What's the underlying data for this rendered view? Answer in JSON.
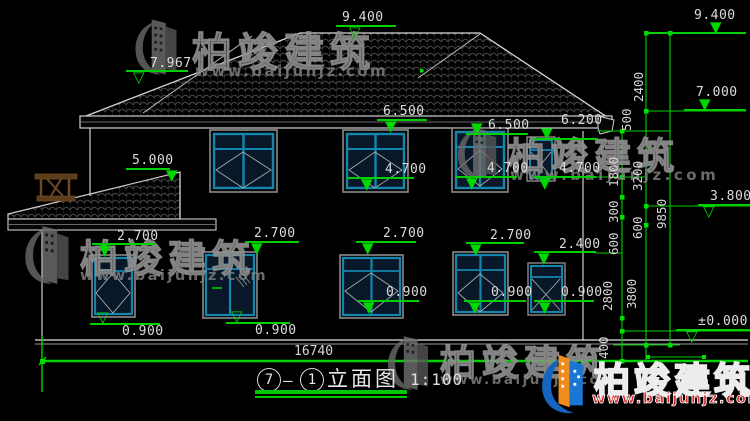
{
  "watermark": {
    "brand": "柏竣建筑",
    "url": "www.baijunjz.com",
    "logo_icon": "baijun-building-swoosh-logo"
  },
  "title": {
    "circle_left": "7",
    "dash": "—",
    "circle_right": "1",
    "name": "立面图",
    "scale": "1:100"
  },
  "bottom_dimension": "16740",
  "elevation_markers": [
    {
      "label": "7.967",
      "text_x": 150,
      "text_y": 57,
      "line_x": 126,
      "line_y": 70,
      "line_w": 62,
      "tri_x": 133,
      "tri_y": 70,
      "style": "hollow"
    },
    {
      "label": "9.400",
      "text_x": 342,
      "text_y": 11,
      "line_x": 336,
      "line_y": 25,
      "line_w": 60,
      "tri_x": 349,
      "tri_y": 25,
      "style": "hollow"
    },
    {
      "label": "9.400",
      "text_x": 694,
      "text_y": 9,
      "line_x": 646,
      "line_y": 32,
      "line_w": 100,
      "tri_x": 710,
      "tri_y": 20,
      "style": "solid"
    },
    {
      "label": "7.000",
      "text_x": 696,
      "text_y": 86,
      "line_x": 684,
      "line_y": 109,
      "line_w": 62,
      "tri_x": 699,
      "tri_y": 97,
      "style": "solid"
    },
    {
      "label": "6.500",
      "text_x": 383,
      "text_y": 105,
      "line_x": 377,
      "line_y": 119,
      "line_w": 50,
      "tri_x": 385,
      "tri_y": 119,
      "style": "solid"
    },
    {
      "label": "6.500",
      "text_x": 488,
      "text_y": 119,
      "line_x": 466,
      "line_y": 133,
      "line_w": 62,
      "tri_x": 471,
      "tri_y": 121,
      "style": "solid"
    },
    {
      "label": "6.200",
      "text_x": 561,
      "text_y": 114,
      "line_x": 534,
      "line_y": 138,
      "line_w": 64,
      "tri_x": 541,
      "tri_y": 126,
      "style": "solid"
    },
    {
      "label": "5.000",
      "text_x": 132,
      "text_y": 154,
      "line_x": 126,
      "line_y": 168,
      "line_w": 44,
      "tri_x": 166,
      "tri_y": 168,
      "style": "solid"
    },
    {
      "label": "4.700",
      "text_x": 385,
      "text_y": 163,
      "line_x": 348,
      "line_y": 177,
      "line_w": 66,
      "tri_x": 361,
      "tri_y": 177,
      "style": "solid"
    },
    {
      "label": "4.700",
      "text_x": 487,
      "text_y": 162,
      "line_x": 455,
      "line_y": 176,
      "line_w": 62,
      "tri_x": 466,
      "tri_y": 176,
      "style": "solid"
    },
    {
      "label": "4.700",
      "text_x": 559,
      "text_y": 162,
      "line_x": 534,
      "line_y": 176,
      "line_w": 62,
      "tri_x": 539,
      "tri_y": 176,
      "style": "solid"
    },
    {
      "label": "2.700",
      "text_x": 117,
      "text_y": 230,
      "line_x": 92,
      "line_y": 243,
      "line_w": 64,
      "tri_x": 99,
      "tri_y": 243,
      "style": "solid"
    },
    {
      "label": "2.700",
      "text_x": 254,
      "text_y": 227,
      "line_x": 245,
      "line_y": 241,
      "line_w": 54,
      "tri_x": 251,
      "tri_y": 241,
      "style": "solid"
    },
    {
      "label": "2.700",
      "text_x": 383,
      "text_y": 227,
      "line_x": 356,
      "line_y": 241,
      "line_w": 60,
      "tri_x": 362,
      "tri_y": 241,
      "style": "solid"
    },
    {
      "label": "2.700",
      "text_x": 490,
      "text_y": 229,
      "line_x": 466,
      "line_y": 242,
      "line_w": 58,
      "tri_x": 470,
      "tri_y": 242,
      "style": "solid"
    },
    {
      "label": "2.400",
      "text_x": 559,
      "text_y": 238,
      "line_x": 534,
      "line_y": 251,
      "line_w": 62,
      "tri_x": 538,
      "tri_y": 251,
      "style": "solid"
    },
    {
      "label": "0.900",
      "text_x": 122,
      "text_y": 325,
      "line_x": 90,
      "line_y": 323,
      "line_w": 70,
      "tri_x": 97,
      "tri_y": 310,
      "style": "hollow"
    },
    {
      "label": "0.900",
      "text_x": 255,
      "text_y": 324,
      "line_x": 226,
      "line_y": 322,
      "line_w": 64,
      "tri_x": 231,
      "tri_y": 309,
      "style": "hollow"
    },
    {
      "label": "0.900",
      "text_x": 386,
      "text_y": 286,
      "line_x": 357,
      "line_y": 300,
      "line_w": 62,
      "tri_x": 363,
      "tri_y": 300,
      "style": "solid"
    },
    {
      "label": "0.900",
      "text_x": 491,
      "text_y": 286,
      "line_x": 464,
      "line_y": 300,
      "line_w": 62,
      "tri_x": 469,
      "tri_y": 300,
      "style": "solid"
    },
    {
      "label": "0.900",
      "text_x": 561,
      "text_y": 286,
      "line_x": 534,
      "line_y": 300,
      "line_w": 60,
      "tri_x": 539,
      "tri_y": 300,
      "style": "solid"
    },
    {
      "label": "3.800",
      "text_x": 710,
      "text_y": 190,
      "line_x": 698,
      "line_y": 204,
      "line_w": 52,
      "tri_x": 703,
      "tri_y": 204,
      "style": "hollow"
    },
    {
      "label": "±0.000",
      "text_x": 698,
      "text_y": 315,
      "line_x": 676,
      "line_y": 329,
      "line_w": 74,
      "tri_x": 686,
      "tri_y": 329,
      "style": "hollow"
    }
  ],
  "vertical_dims": [
    {
      "label": "2400",
      "x": 631,
      "y": 55
    },
    {
      "label": "500",
      "x": 619,
      "y": 88
    },
    {
      "label": "1800",
      "x": 606,
      "y": 140
    },
    {
      "label": "3200",
      "x": 630,
      "y": 144
    },
    {
      "label": "300",
      "x": 606,
      "y": 180
    },
    {
      "label": "600",
      "x": 630,
      "y": 196
    },
    {
      "label": "600",
      "x": 606,
      "y": 212
    },
    {
      "label": "9850",
      "x": 654,
      "y": 182
    },
    {
      "label": "2800",
      "x": 600,
      "y": 264
    },
    {
      "label": "3800",
      "x": 624,
      "y": 262
    },
    {
      "label": "400",
      "x": 596,
      "y": 316
    }
  ]
}
